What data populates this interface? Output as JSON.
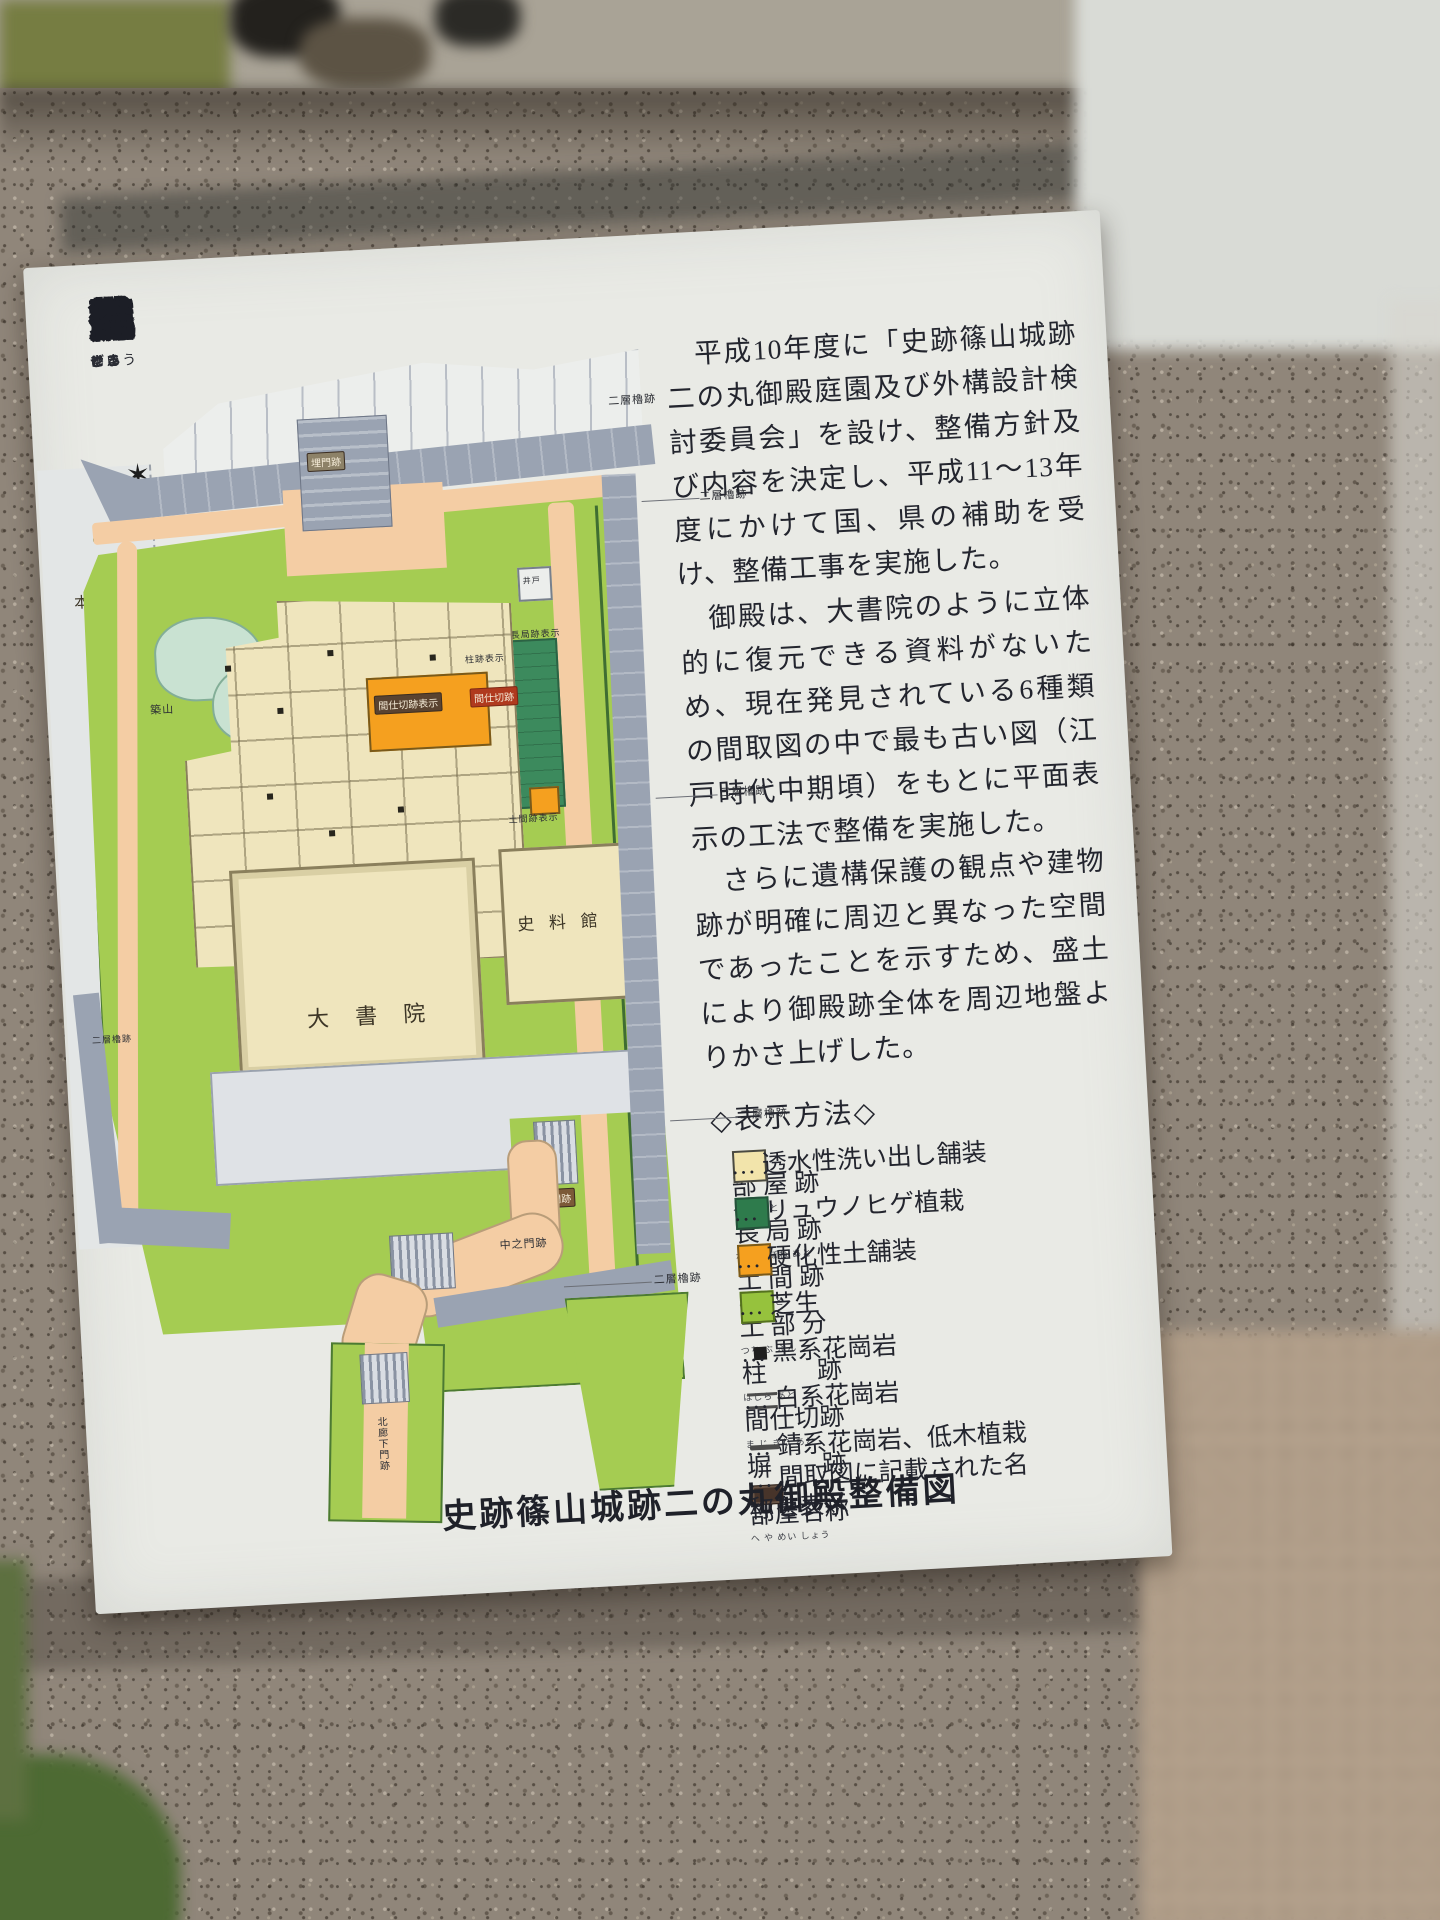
{
  "sign": {
    "title": {
      "text": "史跡篠山城跡二の丸御殿整備",
      "ruby": [
        [
          "史",
          "し"
        ],
        [
          "跡",
          "せき"
        ],
        [
          "篠",
          "ささ"
        ],
        [
          "山",
          "やま"
        ],
        [
          "城",
          "じょう"
        ],
        [
          "跡",
          "せき"
        ],
        [
          "二",
          "に"
        ],
        [
          "の",
          ""
        ],
        [
          "丸",
          "まる"
        ],
        [
          "御",
          "ご"
        ],
        [
          "殿",
          "てん"
        ],
        [
          "整",
          "せい"
        ],
        [
          "備",
          "び"
        ]
      ]
    },
    "paragraphs": [
      "　平成10年度に「史跡篠山城跡二の丸御殿庭園及び外構設計検討委員会」を設け、整備方針及び内容を決定し、平成11〜13年度にかけて国、県の補助を受け、整備工事を実施した。",
      "　御殿は、大書院のように立体的に復元できる資料がないため、現在発見されている6種類の間取図の中で最も古い図（江戸時代中期頃）をもとに平面表示の工法で整備を実施した。",
      "　さらに遺構保護の観点や建物跡が明確に周辺と異なった空間であったことを示すため、盛土により御殿跡全体を周辺地盤よりかさ上げした。"
    ],
    "legend": {
      "heading": "◇表示方法◇",
      "items": [
        {
          "term": "部 屋 跡",
          "reading": "へ や あと",
          "swatch": "cream",
          "desc": "… 透水性洗い出し舗装"
        },
        {
          "term": "長 局 跡",
          "reading": "なが つぼね あと",
          "swatch": "darkgreen",
          "desc": "… リュウノヒゲ植栽"
        },
        {
          "term": "土 間 跡",
          "reading": "ど ま あと",
          "swatch": "orange",
          "desc": "… 硬化性土舗装"
        },
        {
          "term": "土 部 分",
          "reading": "つち ぶ ぶん",
          "swatch": "green",
          "desc": "… 芝生"
        },
        {
          "term": "柱　　跡",
          "reading": "はしら あと",
          "swatch": "blacksq",
          "desc": "… 黒系花崗岩"
        },
        {
          "term": "間仕切跡",
          "reading": "ま じ きり あと",
          "swatch": "dblline",
          "desc": "… 白系花崗岩"
        },
        {
          "term": "塀　　跡",
          "reading": "へい あと",
          "swatch": "line",
          "desc": "… 錆系花崗岩、低木植栽"
        },
        {
          "term": "部屋名称",
          "reading": "へ や めい しょう",
          "swatch": "namechip",
          "desc": "… 間取図に記載された名\n称を表示"
        }
      ],
      "colors": {
        "room": "#f2e4ab",
        "nagatsubone": "#2e7b4c",
        "doma": "#f5a01f",
        "grass": "#96c23d"
      }
    },
    "caption": "史跡篠山城跡二の丸御殿整備図",
    "map": {
      "labels": {
        "honmaru": "本　丸",
        "daishoin": "大 書 院",
        "shiryokan": "史 料 館",
        "uzumimon": "埋門跡",
        "tetsumon": "鉄門跡",
        "nakanomon": "中之門跡",
        "kitaroukamon": "北廊下門跡",
        "tsukiyama": "築山",
        "ido": "井戸",
        "benjo": "便所",
        "oniwa": "御庭表示",
        "ochaya": "御茶屋跡表示",
        "nagatsubone": "長局跡表示",
        "doma": "土間跡表示",
        "hashira": "柱跡表示",
        "majikiri": "間仕切跡表示",
        "majikiri_chip": "間仕切跡",
        "niso": "二層櫓跡",
        "sanso": "三層櫓跡"
      }
    }
  }
}
